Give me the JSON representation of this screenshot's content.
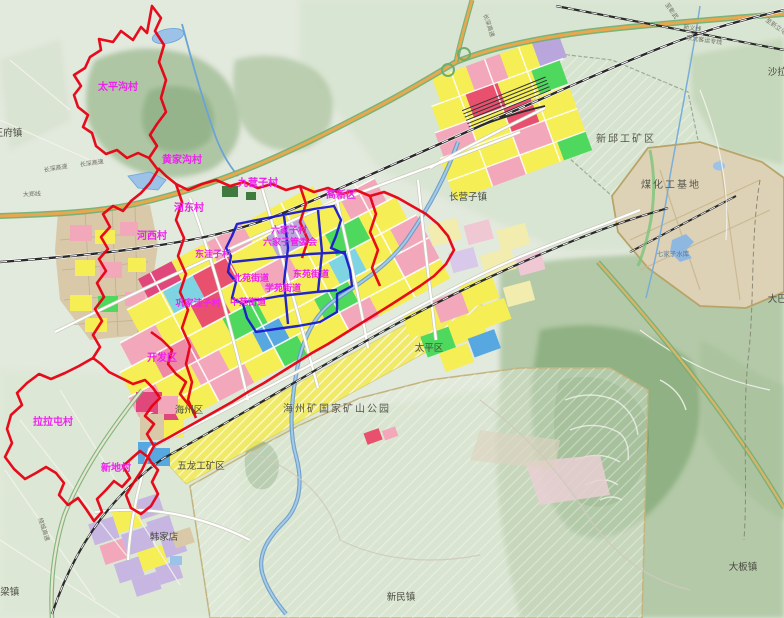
{
  "palette": {
    "boundary_red": "#e60012",
    "boundary_blue": "#1a1acc",
    "label_magenta": "#ee22ee",
    "label_dark": "#4a4a40",
    "residential_yellow": "#f6ee55",
    "commercial_pink": "#f2a8ba",
    "mixed_red": "#e8506e",
    "magenta_red": "#e0487c",
    "industrial_blue": "#57a8e0",
    "green_space": "#4ed95e",
    "public_purple": "#b9a6dc",
    "education_cyan": "#7fd4e4",
    "village_tan": "#d9c9a9",
    "logistics_lavender": "#c7b6e2",
    "highway_orange": "#eaa74e",
    "highway_green": "#6fae6f",
    "water_blue": "#9cc2e8"
  },
  "labels": {
    "villages": {
      "taipinggou": "太平沟村",
      "huangjiagou": "黄家沟村",
      "jiuyingzi": "九营子村",
      "hedong": "河东村",
      "hexi": "河西村",
      "liujiazi": "六家子村",
      "liujiazi_mc": "六家子管委会",
      "dongwazi": "东洼子村",
      "gongjiawazi": "巩家洼子村",
      "lalatun": "拉拉屯村",
      "xindi": "新地村"
    },
    "streets": {
      "beiyuan": "北苑街道",
      "dongyuan": "东苑街道",
      "xueyuan": "学苑街道",
      "zhongyuan": "中苑街道"
    },
    "districts": {
      "gaoxin": "高新区",
      "kaifa": "开发区",
      "taiping": "太平区",
      "haizhou": "海州区"
    },
    "towns": {
      "wangfu": "王府镇",
      "changyingzi": "长营子镇",
      "daba": "大巴镇",
      "daban": "大板镇",
      "xinmin": "新民镇",
      "dongliang": "东梁镇",
      "hanjiadian": "韩家店",
      "shala": "沙拉镇"
    },
    "zones": {
      "xinqiu": "新邱工矿区",
      "meihua": "煤化工基地",
      "wulong": "五龙工矿区",
      "haizhou_park": "海州矿国家矿山公园"
    },
    "water": {
      "qijiazi": "七家子水库"
    },
    "roads": {
      "changshen_a": "长深高速",
      "changshen_b": "长深高速",
      "changshen_c": "长深高速",
      "dazheng": "大郑线",
      "jingshen": "京沈客运专线",
      "xinyi": "新义线",
      "xinlitun": "至新立屯",
      "raocheng": "绕城高速",
      "zhangwu": "至彰武"
    }
  }
}
